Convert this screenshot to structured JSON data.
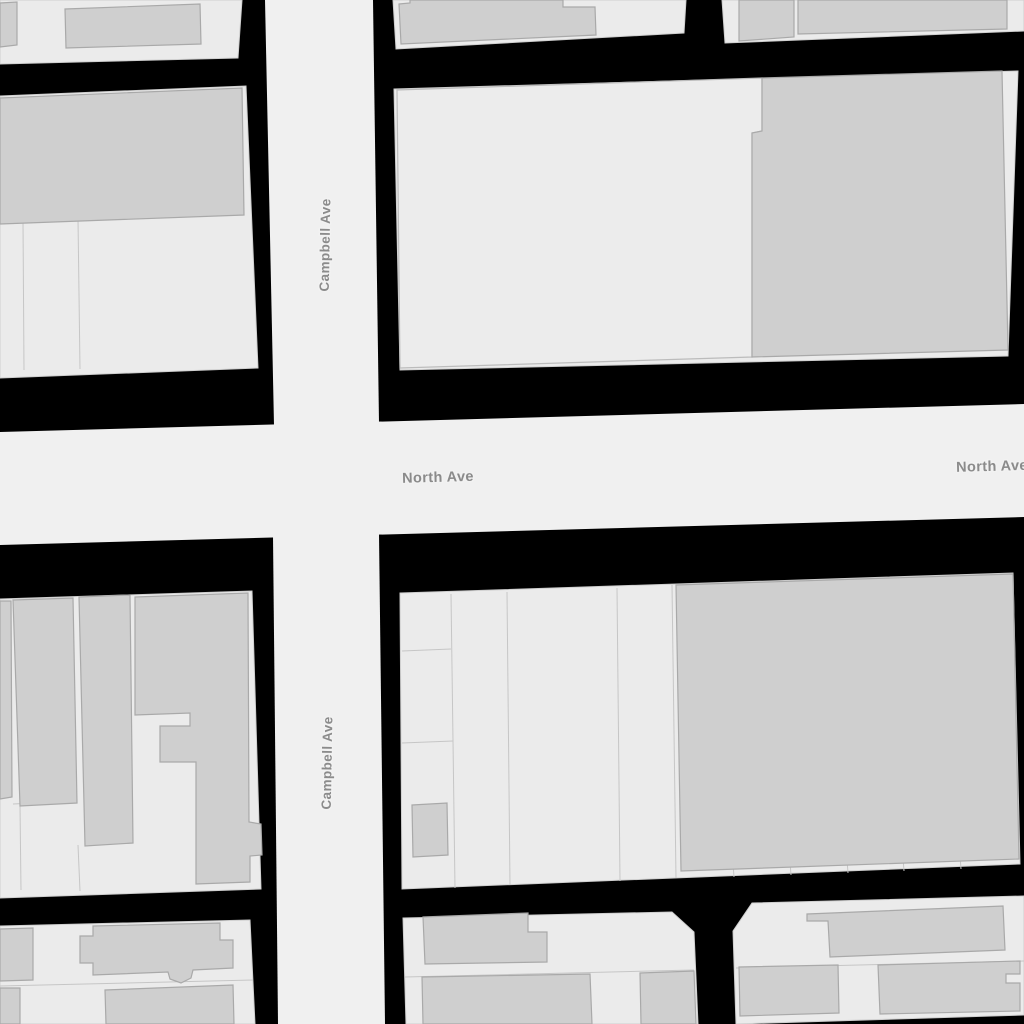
{
  "map": {
    "labels": {
      "campbell_top": "Campbell Ave",
      "campbell_bottom": "Campbell Ave",
      "north_center": "North Ave",
      "north_right": "North Ave"
    },
    "colors": {
      "background": "#000000",
      "road": "#f0f0f0",
      "parcel": "#ebebeb",
      "parcel_line": "#c6c6c6",
      "building": "#cfcfcf",
      "building_outline": "#a9a9a9",
      "light_building": "#ececec",
      "light_building_outline": "#bcbcbc",
      "label_text": "#8b8b8b",
      "label_halo": "#f2f2f2"
    }
  }
}
